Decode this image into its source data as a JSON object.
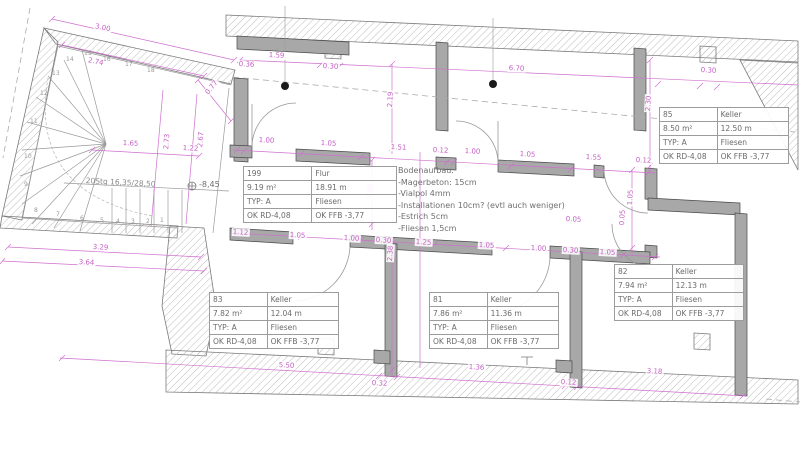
{
  "drawing": {
    "rooms": [
      {
        "id": "199",
        "name": "Flur",
        "area": "9.19 m²",
        "perimeter": "18.91 m",
        "typ": "TYP: A",
        "floor": "Fliesen",
        "ok_rd": "OK RD-4,08",
        "ok_ffb": "OK FFB -3,77"
      },
      {
        "id": "85",
        "name": "Keller",
        "area": "8.50 m²",
        "perimeter": "12.50 m",
        "typ": "TYP: A",
        "floor": "Fliesen",
        "ok_rd": "OK RD-4,08",
        "ok_ffb": "OK FFB -3,77"
      },
      {
        "id": "82",
        "name": "Keller",
        "area": "7.94 m²",
        "perimeter": "12.13 m",
        "typ": "TYP: A",
        "floor": "Fliesen",
        "ok_rd": "OK RD-4,08",
        "ok_ffb": "OK FFB -3,77"
      },
      {
        "id": "83",
        "name": "Keller",
        "area": "7.82 m²",
        "perimeter": "12.04 m",
        "typ": "TYP: A",
        "floor": "Fliesen",
        "ok_rd": "OK RD-4,08",
        "ok_ffb": "OK FFB -3,77"
      },
      {
        "id": "81",
        "name": "Keller",
        "area": "7.86 m²",
        "perimeter": "11.36 m",
        "typ": "TYP: A",
        "floor": "Fliesen",
        "ok_rd": "OK RD-4,08",
        "ok_ffb": "OK FFB -3,77"
      }
    ],
    "floor_note": {
      "title": "Bodenaufbau:",
      "lines": [
        "-Magerbeton: 15cm",
        "-Vialpol 4mm",
        "-Installationen 10cm? (evtl auch weniger)",
        "-Estrich 5cm",
        "-Fliesen 1,5cm"
      ]
    },
    "stair_note": "20Stg 16,35/28,50",
    "level_marker": "-8,45",
    "colors": {
      "dimension": "#c45fc4",
      "wall": "#a8a8a8",
      "text": "#6b6b6b"
    },
    "dimensions": [
      {
        "t": "3.00",
        "x": 95,
        "y": 22,
        "r": 12
      },
      {
        "t": "2.74",
        "x": 88,
        "y": 56,
        "r": 12
      },
      {
        "t": "0.77",
        "x": 203,
        "y": 92,
        "r": -52
      },
      {
        "t": "2.73",
        "x": 162,
        "y": 150,
        "r": -85
      },
      {
        "t": "2.67",
        "x": 196,
        "y": 148,
        "r": -85
      },
      {
        "t": "1.65",
        "x": 122,
        "y": 139,
        "r": 3
      },
      {
        "t": "1.22",
        "x": 182,
        "y": 144,
        "r": 3
      },
      {
        "t": "3.29",
        "x": 92,
        "y": 243,
        "r": 3
      },
      {
        "t": "3.64",
        "x": 78,
        "y": 258,
        "r": 3
      },
      {
        "t": "1.59",
        "x": 268,
        "y": 51,
        "r": 3
      },
      {
        "t": "0.36",
        "x": 238,
        "y": 60,
        "r": 3
      },
      {
        "t": "0.30",
        "x": 322,
        "y": 62,
        "r": 3
      },
      {
        "t": "6.70",
        "x": 508,
        "y": 64,
        "r": 3
      },
      {
        "t": "0.30",
        "x": 700,
        "y": 66,
        "r": 3
      },
      {
        "t": "2.30",
        "x": 644,
        "y": 112,
        "r": -87
      },
      {
        "t": "2.19",
        "x": 386,
        "y": 108,
        "r": -87
      },
      {
        "t": "1.98",
        "x": 366,
        "y": 200,
        "r": -87
      },
      {
        "t": "2.38",
        "x": 386,
        "y": 262,
        "r": -87
      },
      {
        "t": "1.05",
        "x": 626,
        "y": 206,
        "r": -87
      },
      {
        "t": "1.00",
        "x": 258,
        "y": 136,
        "r": 3
      },
      {
        "t": "1.05",
        "x": 320,
        "y": 139,
        "r": 3
      },
      {
        "t": "1.51",
        "x": 390,
        "y": 143,
        "r": 3
      },
      {
        "t": "0.12",
        "x": 432,
        "y": 146,
        "r": 3
      },
      {
        "t": "1.00",
        "x": 464,
        "y": 147,
        "r": 3
      },
      {
        "t": "1.05",
        "x": 519,
        "y": 150,
        "r": 3
      },
      {
        "t": "1.55",
        "x": 585,
        "y": 153,
        "r": 3
      },
      {
        "t": "0.12",
        "x": 635,
        "y": 156,
        "r": 3
      },
      {
        "t": "1.12",
        "x": 232,
        "y": 228,
        "r": 3
      },
      {
        "t": "1.05",
        "x": 289,
        "y": 231,
        "r": 3
      },
      {
        "t": "1.00",
        "x": 343,
        "y": 234,
        "r": 3
      },
      {
        "t": "0.30",
        "x": 375,
        "y": 236,
        "r": 3
      },
      {
        "t": "1.25",
        "x": 415,
        "y": 238,
        "r": 3
      },
      {
        "t": "1.05",
        "x": 478,
        "y": 241,
        "r": 3
      },
      {
        "t": "1.00",
        "x": 530,
        "y": 244,
        "r": 3
      },
      {
        "t": "0.30",
        "x": 562,
        "y": 246,
        "r": 3
      },
      {
        "t": "1.05",
        "x": 599,
        "y": 248,
        "r": 3
      },
      {
        "t": "0.05",
        "x": 565,
        "y": 215,
        "r": 3
      },
      {
        "t": "0.05",
        "x": 618,
        "y": 226,
        "r": -87
      },
      {
        "t": "5.50",
        "x": 278,
        "y": 361,
        "r": 3
      },
      {
        "t": "0.32",
        "x": 371,
        "y": 379,
        "r": 3
      },
      {
        "t": "1.36",
        "x": 468,
        "y": 363,
        "r": 3
      },
      {
        "t": "0.12",
        "x": 560,
        "y": 378,
        "r": 3
      },
      {
        "t": "3.18",
        "x": 646,
        "y": 367,
        "r": 3
      }
    ],
    "stair_treads": [
      {
        "n": "1",
        "x": 160,
        "y": 218
      },
      {
        "n": "2",
        "x": 146,
        "y": 219
      },
      {
        "n": "3",
        "x": 131,
        "y": 219
      },
      {
        "n": "4",
        "x": 116,
        "y": 219
      },
      {
        "n": "5",
        "x": 100,
        "y": 218
      },
      {
        "n": "6",
        "x": 80,
        "y": 216
      },
      {
        "n": "7",
        "x": 56,
        "y": 212
      },
      {
        "n": "8",
        "x": 34,
        "y": 208
      },
      {
        "n": "9",
        "x": 24,
        "y": 182
      },
      {
        "n": "10",
        "x": 24,
        "y": 154
      },
      {
        "n": "11",
        "x": 30,
        "y": 119
      },
      {
        "n": "12",
        "x": 40,
        "y": 91
      },
      {
        "n": "13",
        "x": 52,
        "y": 71
      },
      {
        "n": "14",
        "x": 66,
        "y": 57
      },
      {
        "n": "15",
        "x": 84,
        "y": 51
      },
      {
        "n": "16",
        "x": 103,
        "y": 57
      },
      {
        "n": "17",
        "x": 125,
        "y": 62
      },
      {
        "n": "18",
        "x": 147,
        "y": 68
      }
    ]
  }
}
